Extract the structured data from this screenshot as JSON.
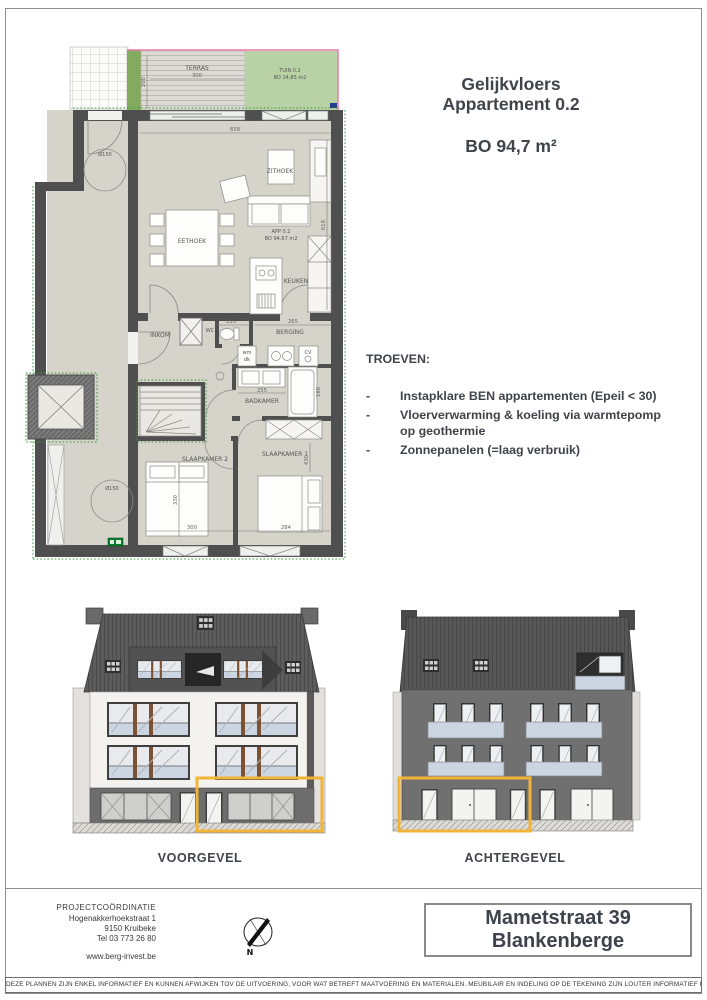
{
  "header": {
    "title_line1": "Gelijkvloers",
    "title_line2": "Appartement 0.2",
    "area": "BO 94,7 m²"
  },
  "troeven": {
    "heading": "TROEVEN:",
    "dash": "-",
    "items": [
      "Instapklare BEN appartementen (Epeil < 30)",
      "Vloerverwarming & koeling via warmtepomp op geothermie",
      "Zonnepanelen (=laag verbruik)"
    ]
  },
  "floorplan": {
    "terras": "TERRAS",
    "tuin_line1": "TUIN 0.2",
    "tuin_line2": "BO 14,85 m2",
    "zithoek": "ZITHOEK",
    "eethoek": "EETHOEK",
    "keuken": "KEUKEN",
    "inkom": "INKOM",
    "wc": "WC",
    "berging": "BERGING",
    "badkamer": "BADKAMER",
    "slaapkamer2": "SLAAPKAMER 2",
    "slaapkamer1": "SLAAPKAMER 1",
    "app_line1": "APP 0.2",
    "app_line2": "BO 94,67 m2",
    "wm_line1": "wm",
    "wm_line2": "dk",
    "cv": "CV",
    "dims": {
      "terras_w": "300",
      "terras_d": "200",
      "living_w": "658",
      "living_d": "618",
      "wc_w": "150",
      "berging_w": "265",
      "badkamer_w": "255",
      "badkamer_d": "160",
      "sk2_d": "330",
      "sk2_w": "300",
      "sk1_w": "284",
      "sk1_d": "430",
      "turn_circle_top": "Ø150",
      "turn_circle_bottom": "Ø150"
    }
  },
  "elevations": {
    "front": "VOORGEVEL",
    "rear": "ACHTERGEVEL"
  },
  "footer": {
    "coordination_title": "PROJECTCOÖRDINATIE",
    "coordination_lines": [
      "Hogenakkerhoekstraat 1",
      "9150 Kruibeke",
      "Tel 03 773 26 80"
    ],
    "website": "www.berg-invest.be",
    "compass_n": "N",
    "address_line1": "Mametstraat 39",
    "address_line2": "Blankenberge",
    "disclaimer": "DEZE PLANNEN ZIJN ENKEL INFORMATIEF EN KUNNEN AFWIJKEN TOV DE UITVOERING, VOOR WAT BETREFT MAATVOERING EN MATERIALEN. MEUBILAIR EN INDELING OP DE TEKENING ZIJN LOUTER INFORMATIEF EN NIET BINDEND."
  },
  "colors": {
    "highlight_orange": "#f2b437",
    "garden_green": "#b9d2a5",
    "hedge_green": "#82ab5e",
    "boundary_pink": "#e878a8",
    "floor_beige": "#d6d3ca",
    "wall_dark": "#4f4f4f",
    "facade_gray": "#707070",
    "roof_gray": "#575757",
    "balustrade_blue": "#ccd6e3",
    "text_dark": "#3e444a"
  }
}
